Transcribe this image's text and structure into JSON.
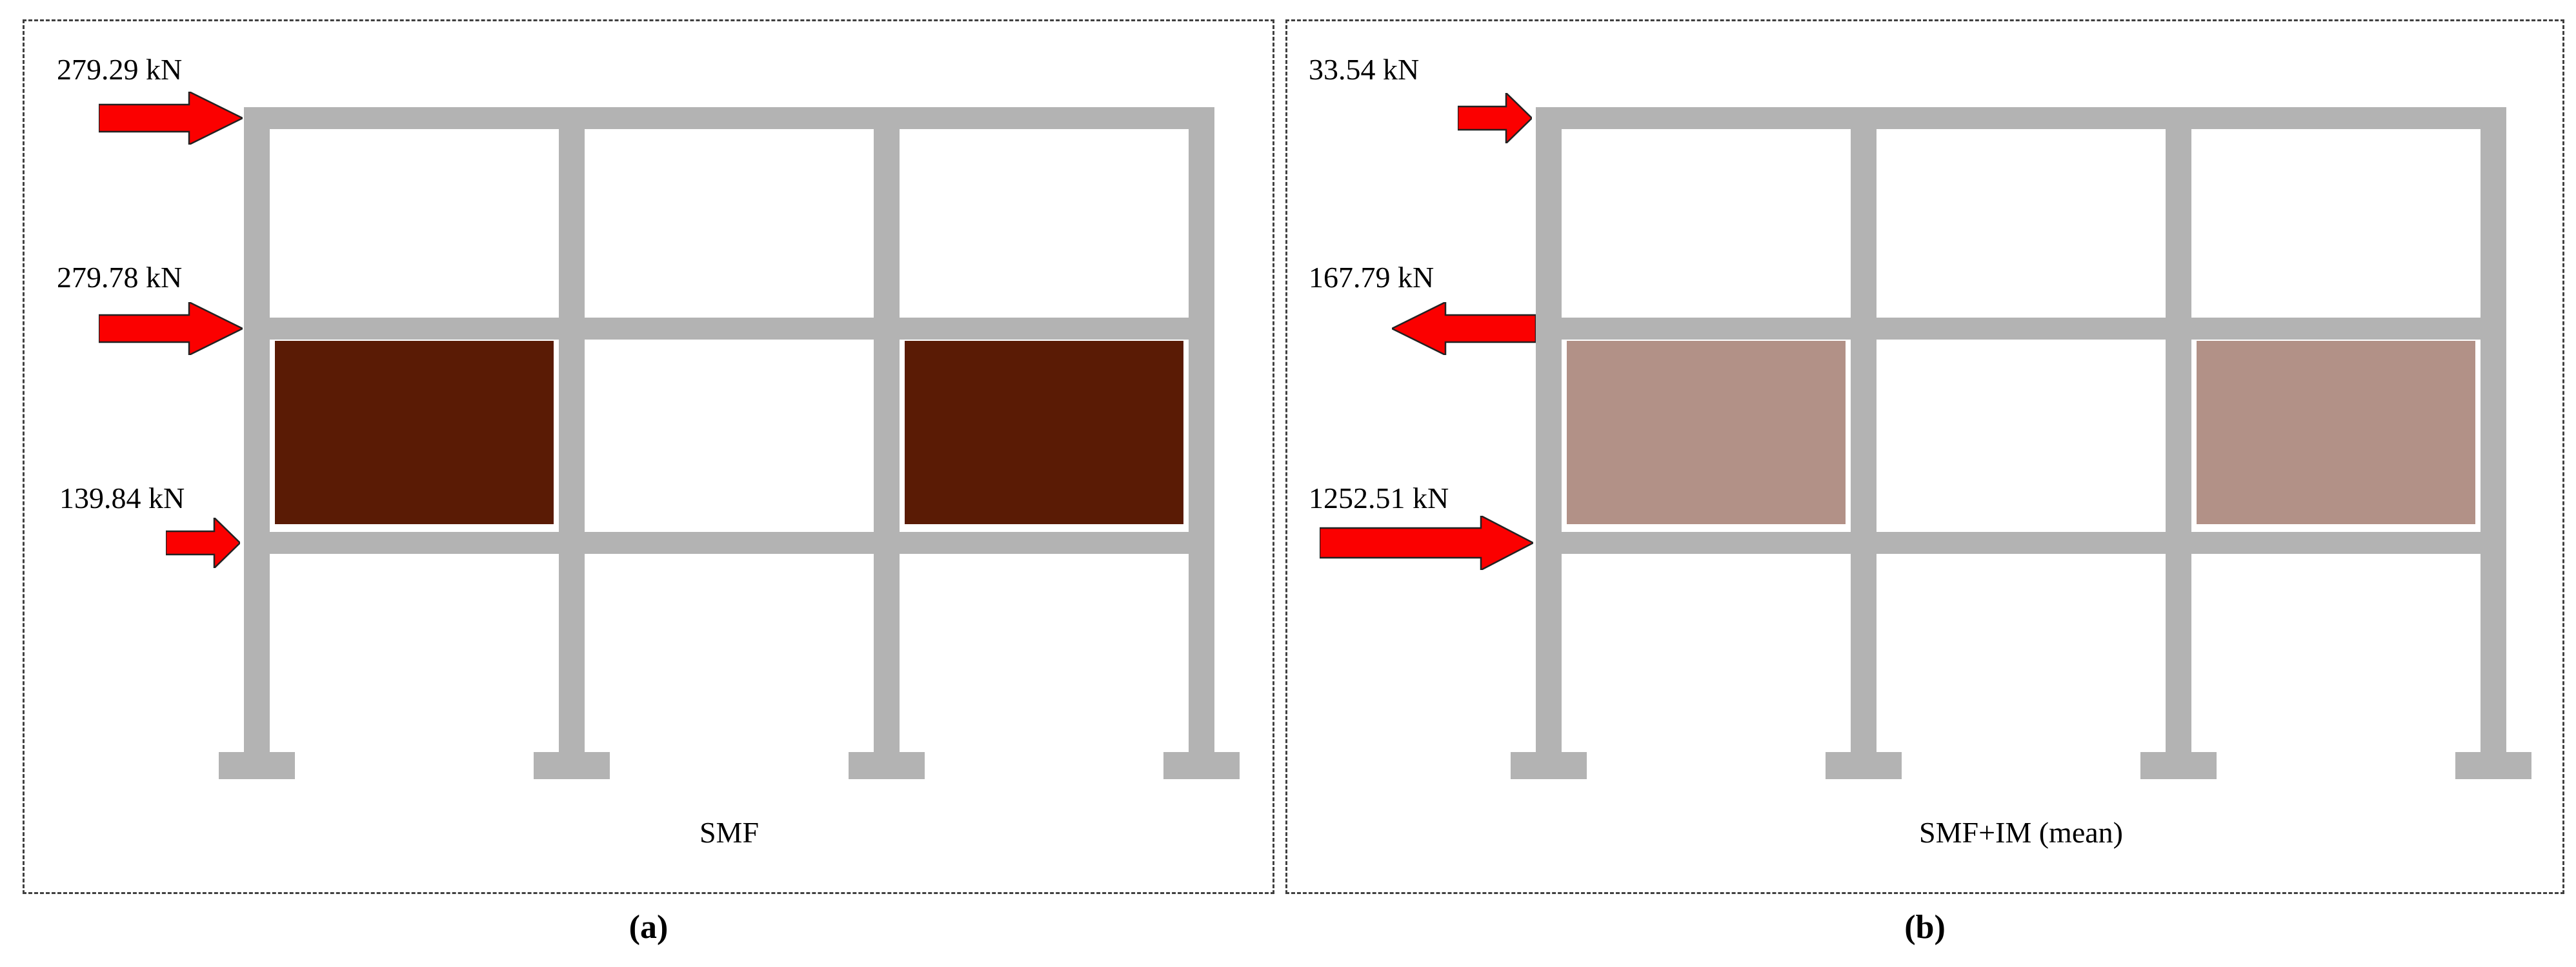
{
  "figure": {
    "panels": [
      {
        "name": "SMF",
        "caption": "(a)",
        "infill_shade": "dark-brown",
        "forces": [
          {
            "label": "279.29 kN",
            "direction": "right",
            "size": "medium",
            "level": "roof-beam"
          },
          {
            "label": "279.78 kN",
            "direction": "right",
            "size": "medium",
            "level": "second-beam"
          },
          {
            "label": "139.84 kN",
            "direction": "right",
            "size": "small",
            "level": "first-beam"
          }
        ]
      },
      {
        "name": "SMF+IM (mean)",
        "caption": "(b)",
        "infill_shade": "light-brown",
        "forces": [
          {
            "label": "33.54 kN",
            "direction": "right",
            "size": "small",
            "level": "roof-beam"
          },
          {
            "label": "167.79 kN",
            "direction": "left",
            "size": "medium",
            "level": "second-beam"
          },
          {
            "label": "1252.51 kN",
            "direction": "right",
            "size": "large",
            "level": "first-beam"
          }
        ]
      }
    ],
    "colors": {
      "frame": "#b3b3b3",
      "infill_dark": "#5a1b05",
      "infill_light": "#b29187",
      "arrow_fill": "#fb0000",
      "arrow_stroke": "#222222",
      "border": "#404040",
      "text": "#000000"
    }
  }
}
